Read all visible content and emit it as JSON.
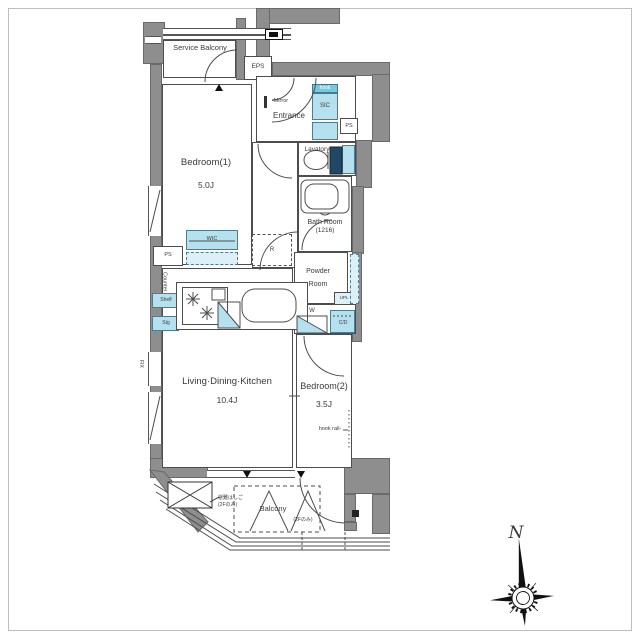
{
  "labels": {
    "service_balcony": "Service Balcony",
    "eps": "EPS",
    "entrance": "Entrance",
    "mirror": "-Mirror",
    "hook": "hook",
    "sic": "SIC",
    "ps_entrance": "PS",
    "lavatory": "Lavatory",
    "bedroom1": "Bedroom(1)",
    "bedroom1_size": "5.0J",
    "bath": "Bath Room",
    "bath_size": "(1216)",
    "powder_line1": "Powder",
    "powder_line2": "Room",
    "wic": "WIC",
    "fridge": "R",
    "ps_west": "PS",
    "counter": "Counter",
    "shelf": "Shelf",
    "stg": "Stg",
    "upl": "UPL",
    "washer": "W",
    "cd": "C/D",
    "ldk": "Living·Dining·Kitchen",
    "ldk_size": "10.4J",
    "bedroom2": "Bedroom(2)",
    "bedroom2_size": "3.5J",
    "hook_rail": "hook rail-",
    "fix": "FIX",
    "balcony": "Balcony",
    "balcony_note": "(2Fのみ)",
    "hatch_line1": "避難はしご",
    "hatch_line2": "(2Fのみ)",
    "north": "N"
  },
  "colors": {
    "wall_gray": "#8e8e8e",
    "fixture_blue": "#b5e0ee",
    "accent_teal": "#79c9dc",
    "toilet_tank": "#1f4866",
    "line": "#4d4d4d"
  }
}
